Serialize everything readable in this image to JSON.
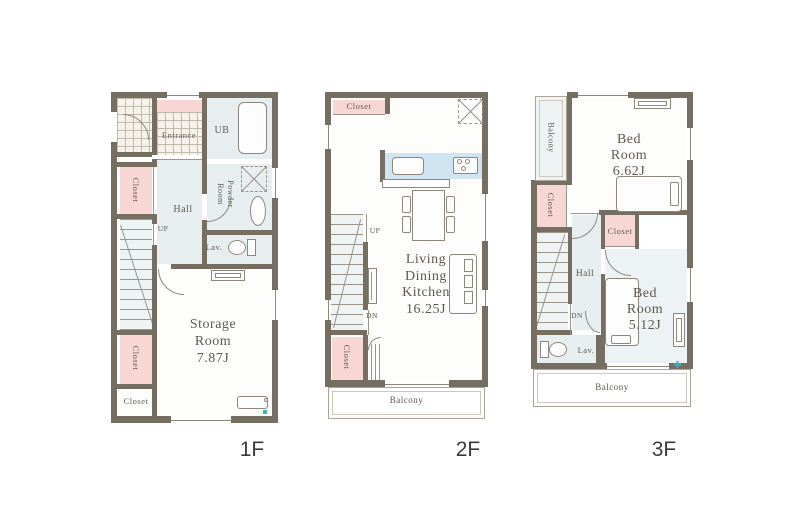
{
  "colors": {
    "wall": "#776e62",
    "pink": "#f7d6d3",
    "tint": "#e7eef0",
    "kitchen": "#cfe6f2",
    "teal": "#3db3c0",
    "text": "#5f594e"
  },
  "f1": {
    "floor_label": "1F",
    "entrance": "Entrance",
    "ub": "UB",
    "powder_l1": "Powder",
    "powder_l2": "Room",
    "closet_upper": "Closet",
    "hall": "Hall",
    "up": "UP",
    "lav": "Lav.",
    "storage_l1": "Storage",
    "storage_l2": "Room",
    "storage_l3": "7.87J",
    "closet_lower": "Closet",
    "closet_bottom": "Closet"
  },
  "f2": {
    "floor_label": "2F",
    "closet_top": "Closet",
    "up": "UP",
    "dn": "DN",
    "ldk_l1": "Living",
    "ldk_l2": "Dining",
    "ldk_l3": "Kitchen",
    "ldk_l4": "16.25J",
    "closet_bottom": "Closet",
    "balcony": "Balcony"
  },
  "f3": {
    "floor_label": "3F",
    "balcony_left": "Balcony",
    "bed1_l1": "Bed",
    "bed1_l2": "Room",
    "bed1_l3": "6.62J",
    "closet_left": "Closet",
    "closet_mid": "Closet",
    "hall": "Hall",
    "dn": "DN",
    "lav": "Lav.",
    "bed2_l1": "Bed",
    "bed2_l2": "Room",
    "bed2_l3": "5.12J",
    "balcony_bottom": "Balcony"
  }
}
